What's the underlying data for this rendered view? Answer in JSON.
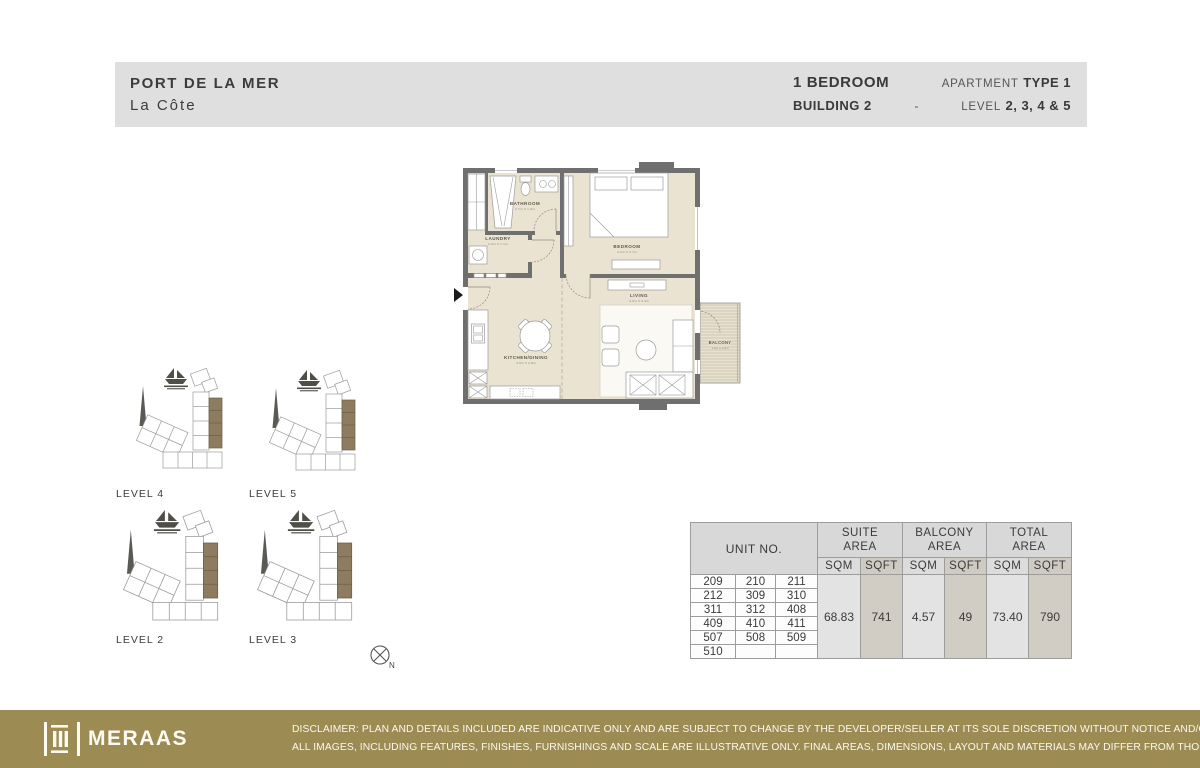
{
  "header": {
    "project": "PORT DE LA MER",
    "subproject": "La Côte",
    "bedroom": "1 BEDROOM",
    "apartment_label": "APARTMENT",
    "type": "TYPE 1",
    "building": "BUILDING 2",
    "dash": "-",
    "level_label": "LEVEL",
    "levels": "2, 3, 4 & 5"
  },
  "floorplan": {
    "rooms": [
      {
        "name": "BATHROOM",
        "dims": "2.7m X 1.9m"
      },
      {
        "name": "LAUNDRY",
        "dims": "2.0m X 1.1m"
      },
      {
        "name": "BEDROOM",
        "dims": "4.2m X 3.7m"
      },
      {
        "name": "LIVING",
        "dims": "4.9m X 4.4m"
      },
      {
        "name": "KITCHEN/DINING",
        "dims": "3.5m X 2.8m"
      },
      {
        "name": "BALCONY",
        "dims": "1.6m X 2.9m"
      }
    ]
  },
  "keyplans": [
    {
      "label": "LEVEL 4"
    },
    {
      "label": "LEVEL 5"
    },
    {
      "label": "LEVEL 2"
    },
    {
      "label": "LEVEL 3"
    }
  ],
  "compass": {
    "label": "N"
  },
  "table": {
    "unit_header": "UNIT NO.",
    "groups": [
      {
        "line1": "SUITE",
        "line2": "AREA"
      },
      {
        "line1": "BALCONY",
        "line2": "AREA"
      },
      {
        "line1": "TOTAL",
        "line2": "AREA"
      }
    ],
    "sub_headers": [
      "SQM",
      "SQFT",
      "SQM",
      "SQFT",
      "SQM",
      "SQFT"
    ],
    "unit_rows": [
      [
        "209",
        "210",
        "211"
      ],
      [
        "212",
        "309",
        "310"
      ],
      [
        "311",
        "312",
        "408"
      ],
      [
        "409",
        "410",
        "411"
      ],
      [
        "507",
        "508",
        "509"
      ],
      [
        "510",
        "",
        ""
      ]
    ],
    "values": [
      "68.83",
      "741",
      "4.57",
      "49",
      "73.40",
      "790"
    ]
  },
  "footer": {
    "brand": "MERAAS",
    "disclaimer_line1": "DISCLAIMER: PLAN AND DETAILS INCLUDED ARE INDICATIVE ONLY AND ARE SUBJECT TO CHANGE BY THE DEVELOPER/SELLER AT ITS SOLE DISCRETION WITHOUT NOTICE AND/OR LIABILITY.",
    "disclaimer_line2": "ALL IMAGES, INCLUDING FEATURES, FINISHES, FURNISHINGS AND SCALE ARE ILLUSTRATIVE ONLY. FINAL AREAS, DIMENSIONS, LAYOUT AND MATERIALS MAY DIFFER FROM THOSE STATED."
  },
  "colors": {
    "header_bar": "#dfdfdf",
    "floor": "#eae3d2",
    "wall": "#6f6f6f",
    "keyplan_highlight": "#8d7c5f",
    "footer_gold": "#9c8c53"
  }
}
